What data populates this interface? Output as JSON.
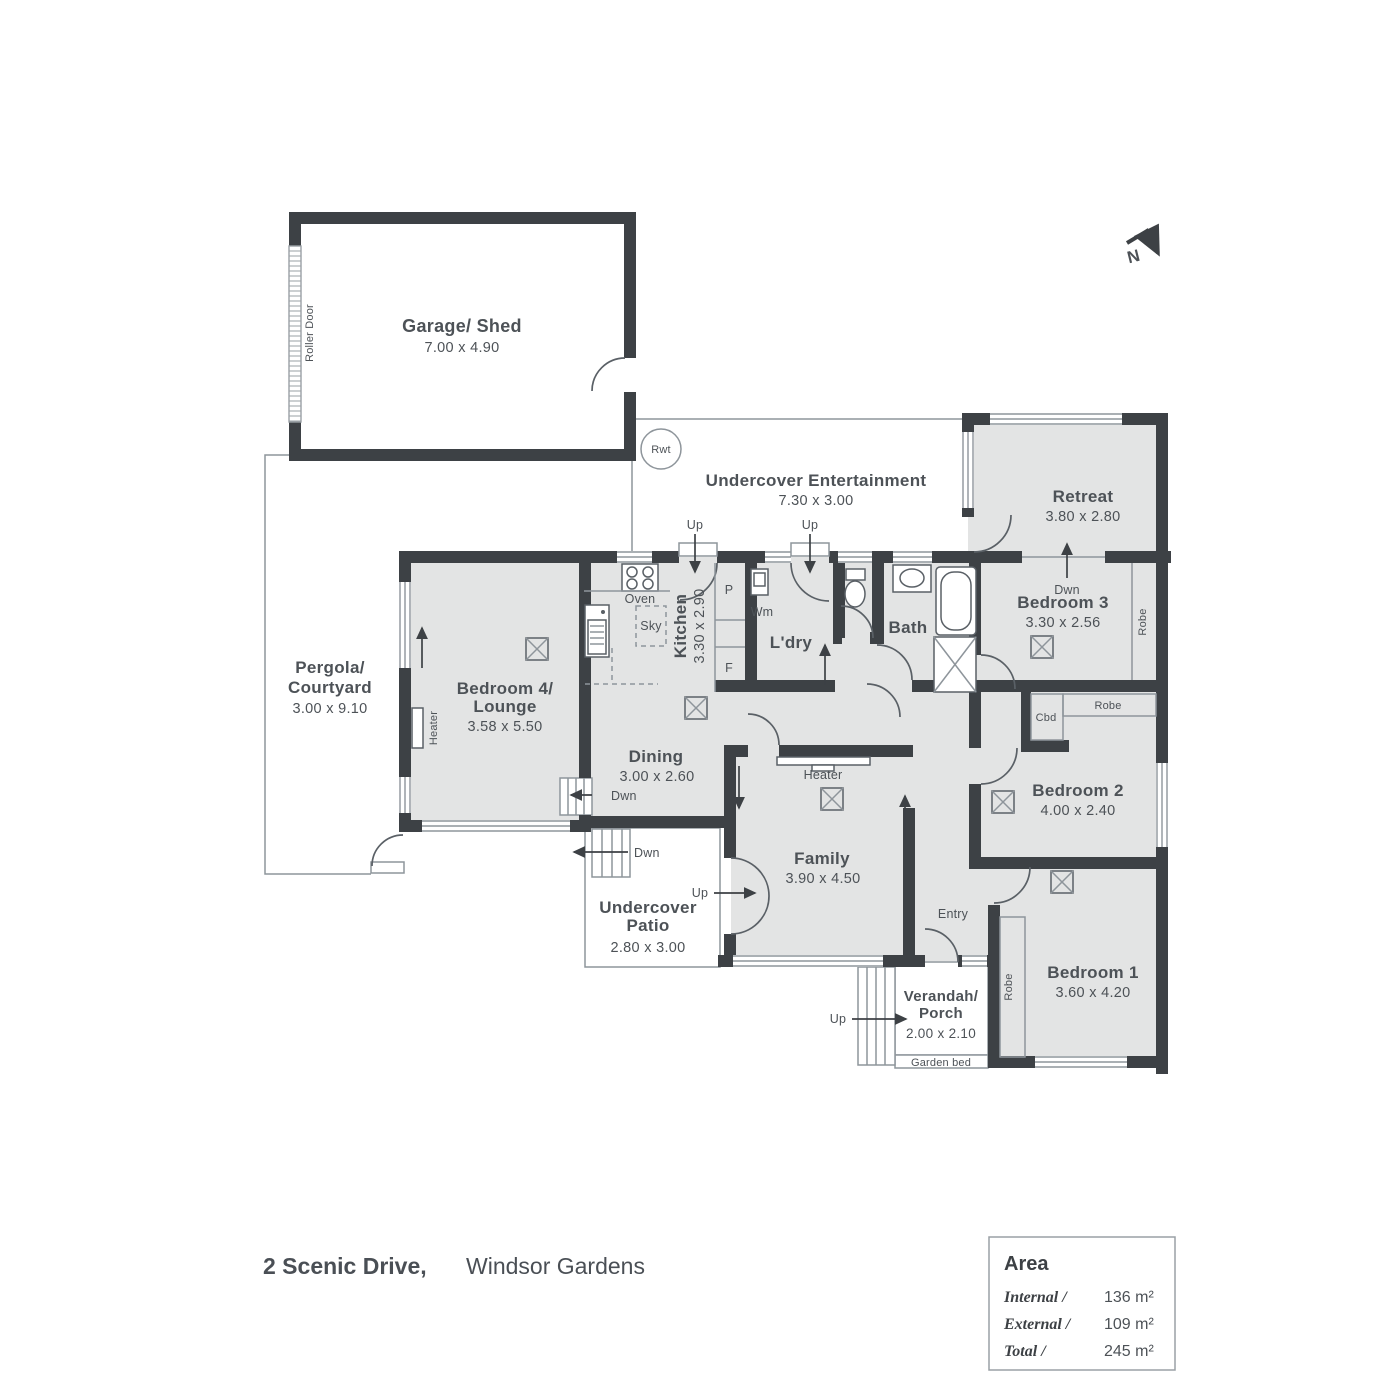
{
  "colors": {
    "wall": "#3d4145",
    "floor": "#e3e4e4",
    "line": "#8e959b",
    "text": "#4d5257"
  },
  "north": {
    "letter": "N"
  },
  "garage": {
    "name": "Garage/ Shed",
    "dims": "7.00 x 4.90",
    "roller_door": "Roller Door"
  },
  "rainwater_tank": {
    "label": "Rwt"
  },
  "entertainment": {
    "name": "Undercover Entertainment",
    "dims": "7.30 x 3.00"
  },
  "retreat": {
    "name": "Retreat",
    "dims": "3.80 x 2.80"
  },
  "bedroom3": {
    "name": "Bedroom 3",
    "dims": "3.30 x 2.56",
    "robe": "Robe"
  },
  "pergola": {
    "name_line1": "Pergola/",
    "name_line2": "Courtyard",
    "dims": "3.00 x 9.10"
  },
  "bedroom4": {
    "name_line1": "Bedroom 4/",
    "name_line2": "Lounge",
    "dims": "3.58 x 5.50",
    "heater": "Heater"
  },
  "kitchen": {
    "name": "Kitchen",
    "dims": "3.30 x 2.90",
    "oven": "Oven",
    "skylight": "Sky",
    "pantry": "P",
    "fridge": "F"
  },
  "laundry": {
    "name": "L'dry",
    "washing_machine": "Wm"
  },
  "bath": {
    "name": "Bath"
  },
  "dining": {
    "name": "Dining",
    "dims": "3.00 x 2.60"
  },
  "family": {
    "name": "Family",
    "dims": "3.90 x 4.50",
    "heater": "Heater"
  },
  "bedroom2": {
    "name": "Bedroom 2",
    "dims": "4.00 x 2.40",
    "robe": "Robe",
    "cupboard": "Cbd"
  },
  "bedroom1": {
    "name": "Bedroom 1",
    "dims": "3.60 x 4.20",
    "robe": "Robe"
  },
  "patio": {
    "name_line1": "Undercover",
    "name_line2": "Patio",
    "dims": "2.80 x 3.00"
  },
  "porch": {
    "name_line1": "Verandah/",
    "name_line2": "Porch",
    "dims": "2.00 x 2.10",
    "garden_bed": "Garden bed"
  },
  "entry": {
    "name": "Entry"
  },
  "stairs": {
    "up": "Up",
    "down": "Dwn"
  },
  "address": {
    "street": "2 Scenic Drive,",
    "suburb": "Windsor Gardens"
  },
  "area_panel": {
    "title": "Area",
    "rows": [
      {
        "label": "Internal /",
        "value": "136 m²"
      },
      {
        "label": "External /",
        "value": "109 m²"
      },
      {
        "label": "Total /",
        "value": "245 m²"
      }
    ]
  }
}
